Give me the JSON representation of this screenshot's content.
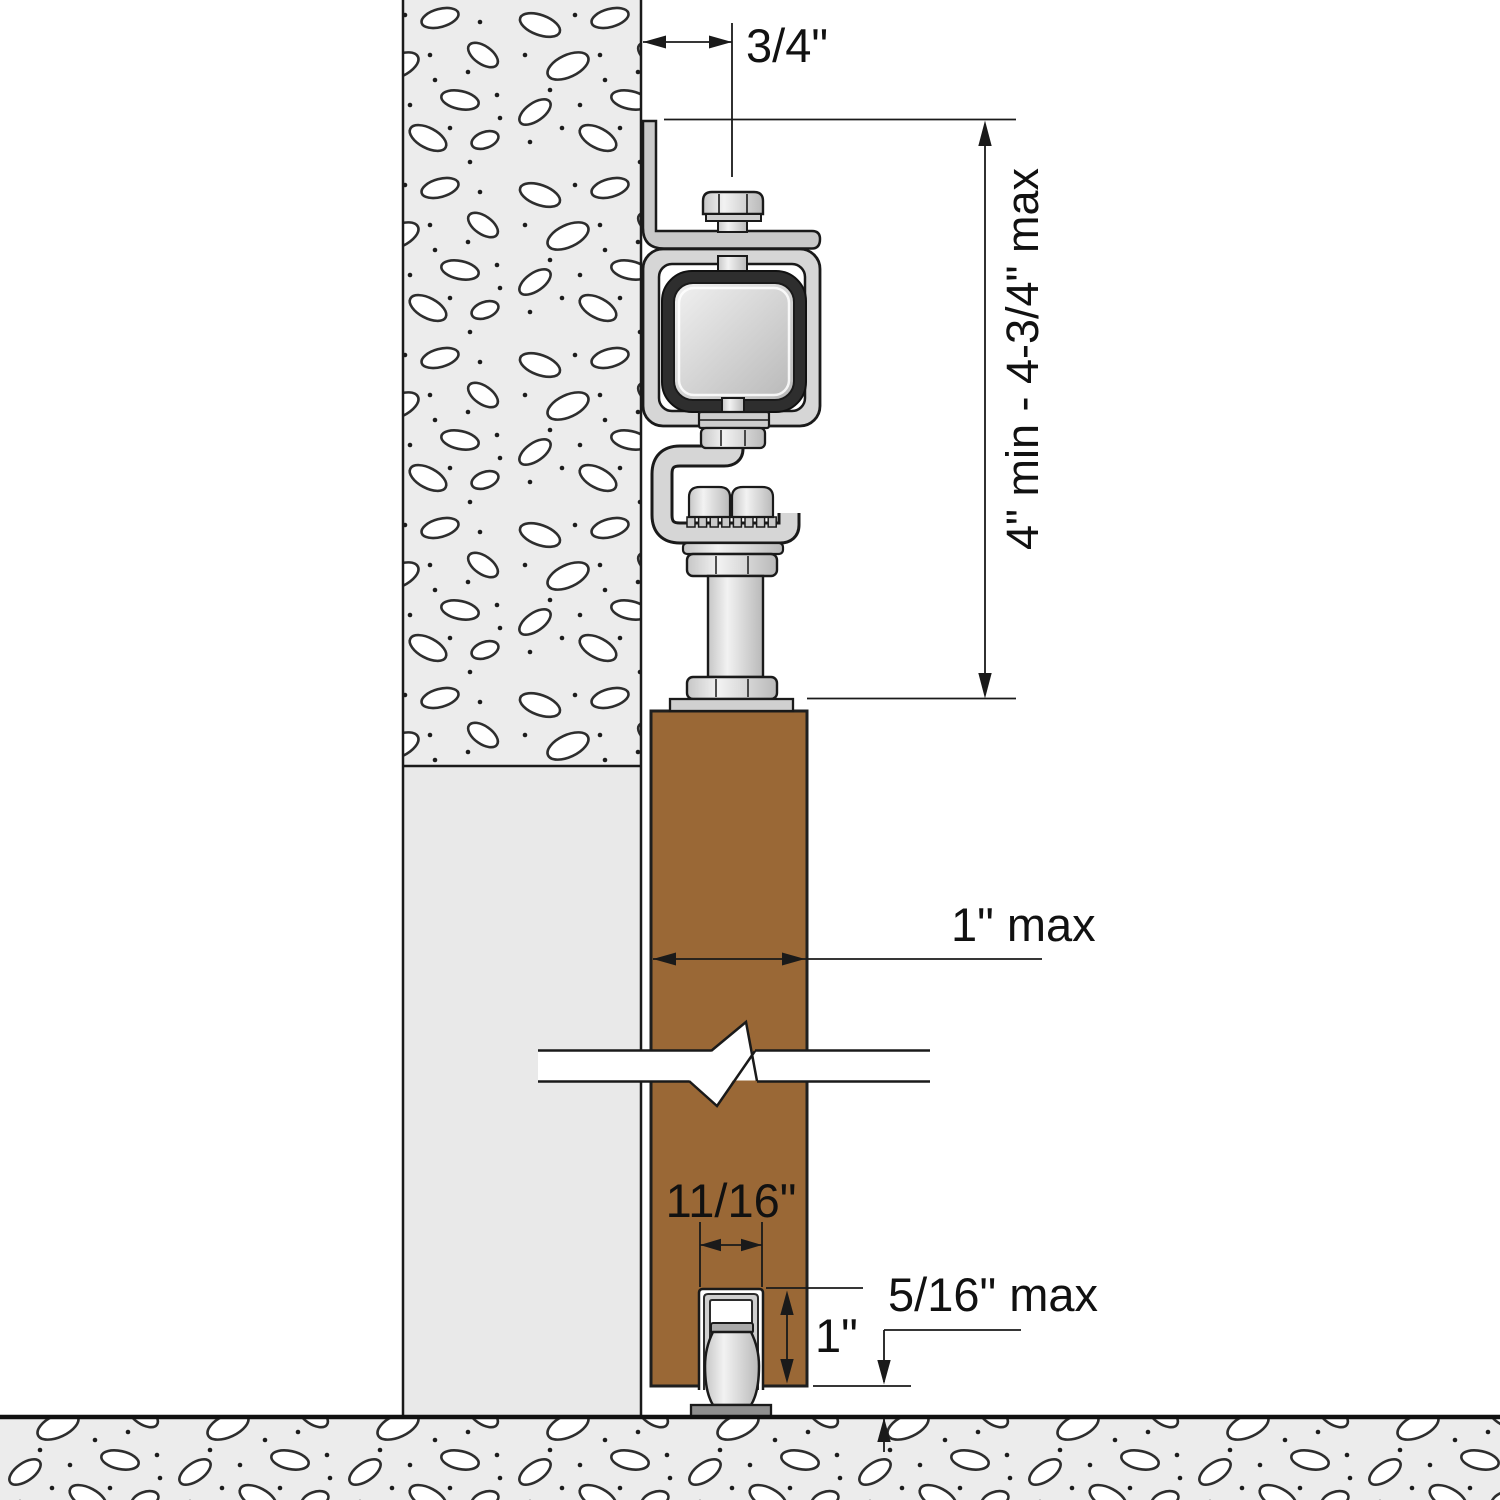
{
  "diagram": {
    "kind": "sliding-door-hardware-cross-section",
    "dimensions": {
      "track_offset": "3/4\"",
      "mount_height": "4\" min - 4-3/4\" max",
      "door_thickness": "1\" max",
      "groove_width": "11/16\"",
      "groove_depth": "1\"",
      "floor_clearance": "5/16\" max"
    },
    "colors": {
      "door": "#9A6836",
      "tire": "#2E2E2E",
      "hardware": "#D6D6D6",
      "wall": "#ECECEC",
      "outline": "#1A1A1A",
      "background": "#FFFFFF"
    }
  }
}
